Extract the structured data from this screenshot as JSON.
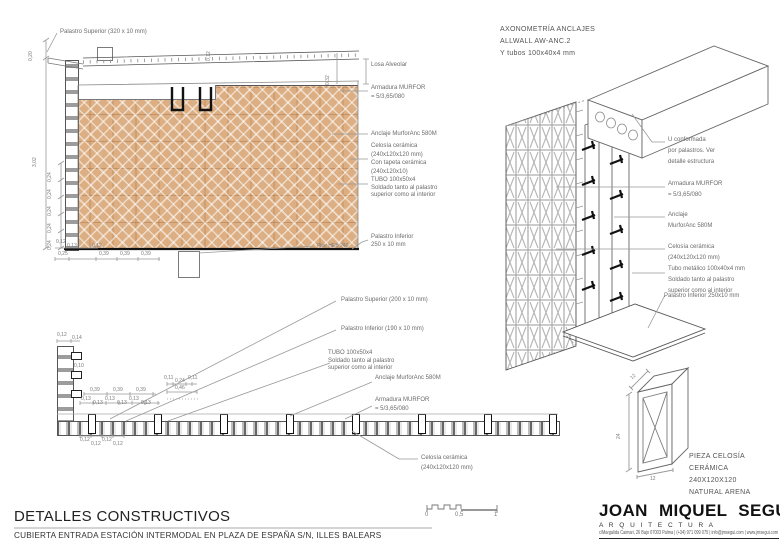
{
  "colors": {
    "tan": "#dcae81",
    "line": "#777777",
    "label": "#6b6b6b",
    "dark": "#111111"
  },
  "top_detail": {
    "palastro_superior": "Palastro Superior (320 x 10 mm)",
    "losa": "Losa Alveolar",
    "armadura": "Armadura MURFOR\n= 5/3,65/080",
    "anclaje": "Anclaje MurforAnc 580M",
    "celosia": "Celosía cerámica\n(240x120x120 mm)\nCon tapeta cerámica\n(240x120x10)",
    "tubo": "TUBO 100x50x4\nSoldado tanto al palastro\nsuperior como al interior",
    "palastro_inferior": "Palastro Inferior\n250 x 10 mm",
    "pilar": "Pilar HEB 240",
    "dims": {
      "v_total": "3,02",
      "v_top": "0,20",
      "v_slab": "0,32",
      "v_joint": "0,12",
      "v_small": "0,24",
      "d12": "0,12",
      "d13": "0,13",
      "d25": "0,25",
      "d39": "0,39"
    }
  },
  "plan_detail": {
    "palastro_superior": "Palastro Superior (200 x 10 mm)",
    "palastro_inferior": "Palastro Inferior (190 x 10 mm)",
    "tubo": "TUBO 100x50x4\nSoldado tanto al palastro\nsuperior como al interior",
    "anclaje": "Anclaje MurforAnc 580M",
    "armadura": "Armadura MURFOR\n= 5/3,65/080",
    "celosia": "Celosía cerámica\n(240x120x120 mm)",
    "dims": {
      "d12": "0,12",
      "d14": "0,14",
      "d10": "0,10",
      "d39": "0,39",
      "d13": "0,13",
      "d11": "0,11",
      "d24": "0,24",
      "d46": "0,46"
    }
  },
  "axon": {
    "title": "AXONOMETRÍA ANCLAJES\nALLWALL AW-ANC.2\nY tubos 100x40x4 mm",
    "u_conformada": "U conformada\npor palastros. Ver\ndetalle estructura",
    "armadura": "Armadura MURFOR\n= 5/3,65/080",
    "anclaje": "Anclaje\nMurforAnc 580M",
    "celosia": "Celosía cerámica\n(240x120x120 mm)",
    "tubo": "Tubo metálico 100x40x4 mm\nSoldado tanto al palastro\nsuperior como al interior",
    "palastro_inferior": "Palastro Inferior 250x10 mm"
  },
  "piece": {
    "label": "PIEZA CELOSÍA CERÁMICA\n240X120X120\nNATURAL ARENA",
    "dim_w": "12",
    "dim_h": "24",
    "dim_d": "12"
  },
  "scalebar": {
    "zero": "0",
    "half": "0,5",
    "one": "1"
  },
  "footer": {
    "title": "DETALLES CONSTRUCTIVOS",
    "subtitle": "CUBIERTA ENTRADA ESTACIÓN INTERMODAL EN PLAZA DE ESPAÑA S/N, ILLES BALEARS"
  },
  "firm": {
    "name": "JOAN MIQUEL SEGUI",
    "discipline": "A R Q U I T E C T U R A",
    "address": "c/Margalida Caimari, 26 Bajo 07003 Palma  |  (+34) 971 099 075  |  info@jmsegui.com  |  www.jmsegui.com"
  }
}
